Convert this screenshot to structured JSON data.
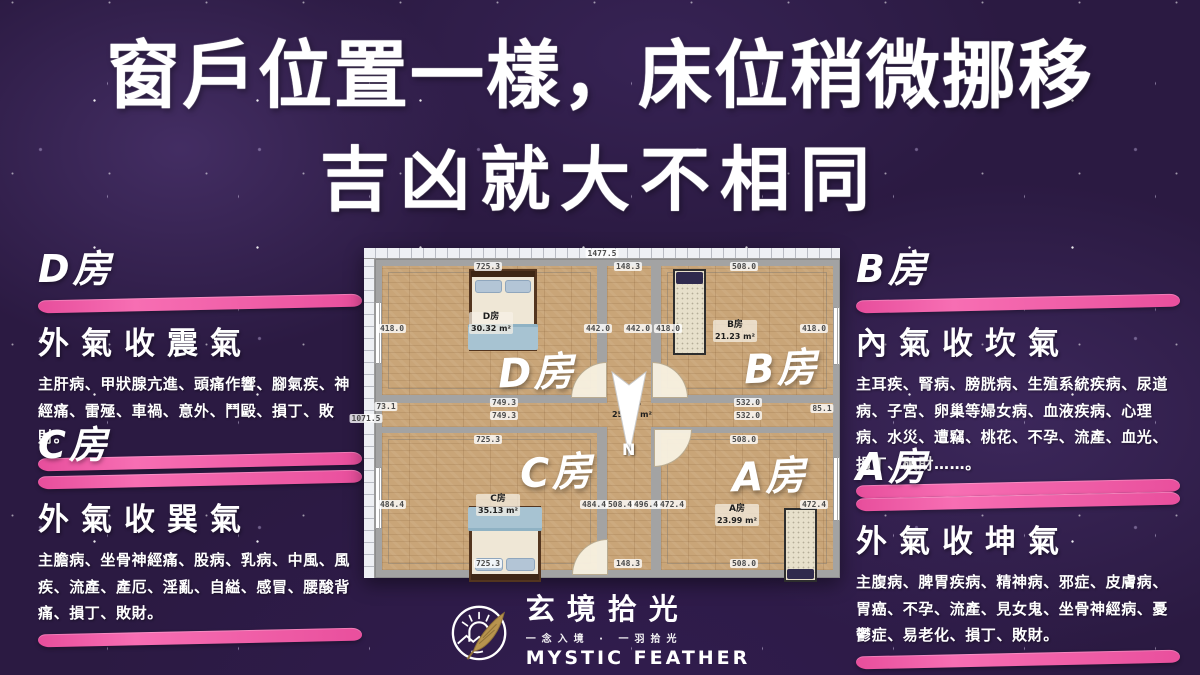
{
  "title": {
    "line1": "窗戶位置一樣，床位稍微挪移",
    "line2": "吉凶就大不相同"
  },
  "sections": {
    "d": {
      "room": "D房",
      "qi": "外氣收震氣",
      "effects": "主肝病、甲狀腺亢進、頭痛作響、腳氣疾、神經痛、雷殛、車禍、意外、鬥毆、損丁、敗財。"
    },
    "c": {
      "room": "C房",
      "qi": "外氣收巽氣",
      "effects": "主膽病、坐骨神經痛、股病、乳病、中風、風疾、流產、產厄、淫亂、自縊、感冒、腰酸背痛、損丁、敗財。"
    },
    "b": {
      "room": "B房",
      "qi": "內氣收坎氣",
      "effects": "主耳疾、腎病、膀胱病、生殖系統疾病、尿道病、子宮、卵巢等婦女病、血液疾病、心理病、水災、遭竊、桃花、不孕、流產、血光、損丁、破財……。"
    },
    "a": {
      "room": "A房",
      "qi": "外氣收坤氣",
      "effects": "主腹病、脾胃疾病、精神病、邪症、皮膚病、胃癌、不孕、流產、見女鬼、坐骨神經病、憂鬱症、易老化、損丁、敗財。"
    }
  },
  "floorplan": {
    "rooms": {
      "d": {
        "big": "D房",
        "label": "D房",
        "area": "30.32 m²"
      },
      "b": {
        "big": "B房",
        "label": "B房",
        "area": "21.23 m²"
      },
      "c": {
        "big": "C房",
        "label": "C房",
        "area": "35.13 m²"
      },
      "a": {
        "big": "A房",
        "label": "A房",
        "area": "23.99 m²"
      }
    },
    "corridor": {
      "label": "走廊",
      "area": "25.10 m²"
    },
    "compass": "N",
    "dims": [
      {
        "t": "1477.5",
        "x": 238,
        "y": 1
      },
      {
        "t": "725.3",
        "x": 124,
        "y": 14
      },
      {
        "t": "148.3",
        "x": 264,
        "y": 14
      },
      {
        "t": "508.0",
        "x": 380,
        "y": 14
      },
      {
        "t": "418.0",
        "x": 28,
        "y": 76
      },
      {
        "t": "442.0",
        "x": 234,
        "y": 76
      },
      {
        "t": "442.0",
        "x": 274,
        "y": 76
      },
      {
        "t": "418.0",
        "x": 304,
        "y": 76
      },
      {
        "t": "418.0",
        "x": 450,
        "y": 76
      },
      {
        "t": "73.1",
        "x": 22,
        "y": 154
      },
      {
        "t": "749.3",
        "x": 140,
        "y": 150
      },
      {
        "t": "749.3",
        "x": 140,
        "y": 163
      },
      {
        "t": "532.0",
        "x": 384,
        "y": 150
      },
      {
        "t": "532.0",
        "x": 384,
        "y": 163
      },
      {
        "t": "85.1",
        "x": 458,
        "y": 156
      },
      {
        "t": "1071.5",
        "x": 2,
        "y": 166
      },
      {
        "t": "725.3",
        "x": 124,
        "y": 187
      },
      {
        "t": "508.0",
        "x": 380,
        "y": 187
      },
      {
        "t": "484.4",
        "x": 28,
        "y": 252
      },
      {
        "t": "484.4",
        "x": 230,
        "y": 252
      },
      {
        "t": "508.4",
        "x": 256,
        "y": 252
      },
      {
        "t": "496.4",
        "x": 282,
        "y": 252
      },
      {
        "t": "472.4",
        "x": 308,
        "y": 252
      },
      {
        "t": "472.4",
        "x": 450,
        "y": 252
      },
      {
        "t": "725.3",
        "x": 124,
        "y": 311
      },
      {
        "t": "148.3",
        "x": 264,
        "y": 311
      },
      {
        "t": "508.0",
        "x": 380,
        "y": 311
      }
    ]
  },
  "logo": {
    "brand": "玄境拾光",
    "tagline": "一念入境 · 一羽拾光",
    "english": "MYSTIC FEATHER"
  },
  "colors": {
    "background": "#2b1a42",
    "accent_pink": "#f160a8",
    "wood": "#c9a578",
    "wall": "#a3a3a3"
  }
}
